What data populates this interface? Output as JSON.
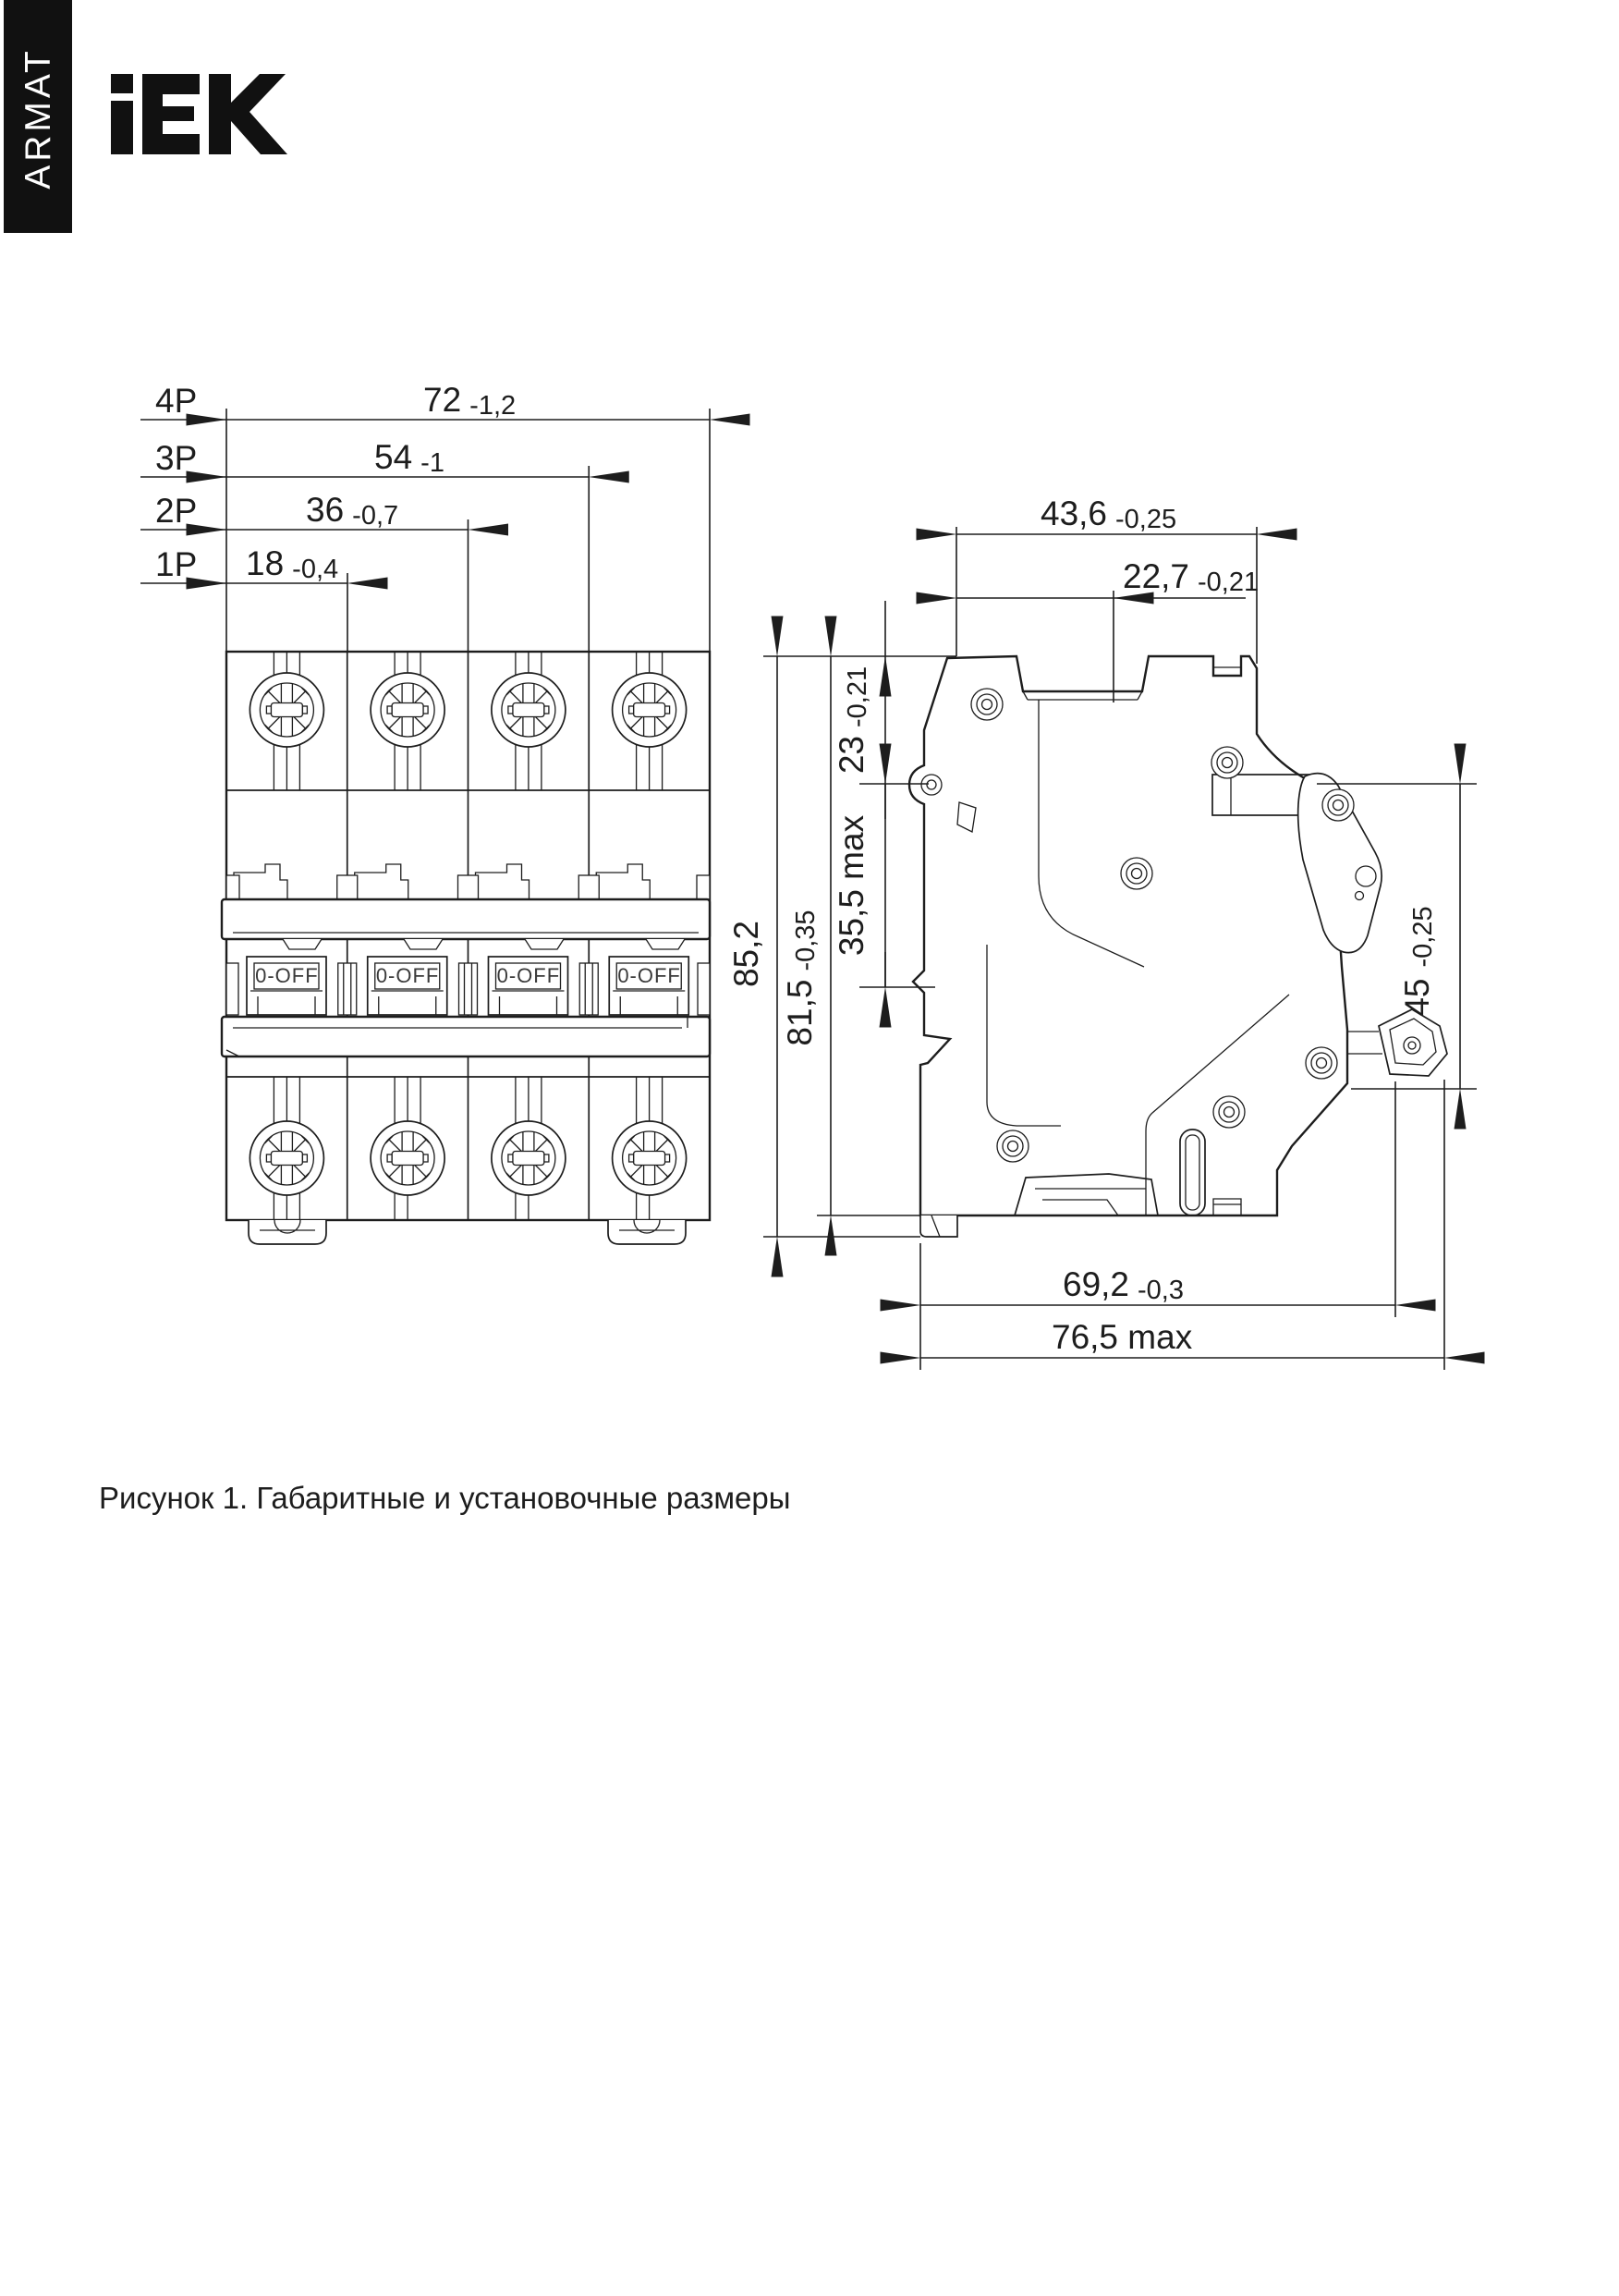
{
  "brand": {
    "sidebar_label": "ARMAT",
    "logo_text": "IEK"
  },
  "caption": "Рисунок 1. Габаритные и установочные размеры",
  "colors": {
    "ink": "#1d1d1d",
    "paper": "#ffffff"
  },
  "front_view": {
    "handle_label": "0-OFF",
    "pole_dims": [
      {
        "pole": "4P",
        "value": "72",
        "tolerance": "-1,2"
      },
      {
        "pole": "3P",
        "value": "54",
        "tolerance": "-1"
      },
      {
        "pole": "2P",
        "value": "36",
        "tolerance": "-0,7"
      },
      {
        "pole": "1P",
        "value": "18",
        "tolerance": "-0,4"
      }
    ]
  },
  "side_view": {
    "dim_width_top": {
      "value": "43,6",
      "tolerance": "-0,25"
    },
    "dim_width_handle": {
      "value": "22,7",
      "tolerance": "-0,21"
    },
    "dim_handle_depth": {
      "value": "23",
      "tolerance": "-0,21"
    },
    "dim_latch_travel": {
      "value": "35,5 max"
    },
    "dim_height_total": {
      "value": "85,2"
    },
    "dim_height_body": {
      "value": "81,5",
      "tolerance": "-0,35"
    },
    "dim_front_height": {
      "value": "45",
      "tolerance": "-0,25"
    },
    "dim_depth_body": {
      "value": "69,2",
      "tolerance": "-0,3"
    },
    "dim_depth_max": {
      "value": "76,5 max"
    }
  }
}
